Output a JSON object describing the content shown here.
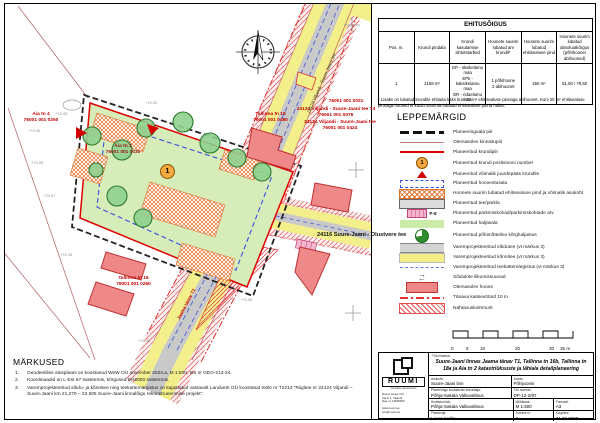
{
  "ehitusoigus": {
    "title": "EHITUSÕIGUS",
    "headers": [
      "Pos. nr.",
      "Krundi pindala",
      "Krundi kasutamise sihtotstarbed",
      "Hoonete suurim lubatud arv krundil*",
      "Hoonete suurim lubatud ehitisealune pind",
      "Hoonete suurim lubatud absoluutkõrgus (põhihoone/ abihooned)"
    ],
    "row": {
      "pos": "1",
      "pindala": "2169 m²",
      "sihtotstarbed": "EP - üksikelamu maa\nEPk - kaksikelamu maa\nER - ridaelamu maa",
      "arv": "1 põhihoone\n2 abihoonet",
      "pind": "450 m²",
      "korgus": "81,50 / 79,50"
    },
    "footnote": "* Lisaks on lubatud krundile ehitada kaks kuni 20 m² ehitisealuse pinnaga abihoonet. Kuni 20 m² ehitisealuse pinnaga hooned ei kuulu suurima lubatud ehitisealuse pinna hulka."
  },
  "leppemargid": {
    "title": "LEPPEMÄRGID",
    "items": [
      {
        "label": "Planeeringuala piir"
      },
      {
        "label": "Olemasolev kinnistupiir"
      },
      {
        "label": "Planeeritud krundipiir"
      },
      {
        "label": "Planeeritud krundi positsiooni number",
        "tag": "1"
      },
      {
        "label": "Planeeritud võimalik juurdepääs krundile"
      },
      {
        "label": "Planeeritud hoonestusala"
      },
      {
        "label": "Hoonete suurim lubatud ehitisealune pind ja võimalik asukoht"
      },
      {
        "label": "Planeeritud tee/parkla"
      },
      {
        "label": "Planeeritud parkimiskohad/parkimiskohtade arv",
        "tag": "P-8"
      },
      {
        "label": "Planeeritud haljasala"
      },
      {
        "label": "Planeeritud põhimõtteline kõrghaljastus"
      },
      {
        "label": "Varemprojekteeritud sõidutee (vt märkus 3)"
      },
      {
        "label": "Varemprojekteeritud kõnnitee (vt märkus 3)"
      },
      {
        "label": "Varemprojekteeritud teekattemärgistus (vt märkus 3)"
      },
      {
        "label": "Sõidukite liikumissuunad"
      },
      {
        "label": "Olemasolev hoone"
      },
      {
        "label": "Tänava kaitsevöönd 10 m"
      },
      {
        "label": "Nähtavuskolmnurk"
      }
    ],
    "arrow_right": "→",
    "arrow_left": "←"
  },
  "markused": {
    "title": "MÄRKUSED",
    "items": [
      {
        "n": "1.",
        "text": "Geodeetilise alusplaani on koostanud WeW OÜ november 2024.a, M 1:500, töö nr GEO-213-24."
      },
      {
        "n": "2.",
        "text": "Koordinaadid on L-Est 97 süsteemis, kõrgused EH2000 süsteemis."
      },
      {
        "n": "3.",
        "text": "Varemprojekteeritud sõidu- ja kõnnitee ning teekattemärgistus on kajastatud vastavalt Landverk OÜ koostatud tööle nr T2213 \"Riigitee nr 24124 Viljandi – Suure-Jaani km 21,270 – 22,505 Suure-Jaani linnalõigu rekonstrueerimise projekt\"."
      }
    ]
  },
  "titleblock": {
    "work_label": "Töö nimetus:",
    "work_title": "Suure-Jaani linnas Jaama tänav T1, Tallinna tn 16b, Tallinna tn 18a ja Aia tn 2 katastriüksuste ja lähiala detailplaneering",
    "asukoht_label": "Asukoht:",
    "asukoht": "Suure-Jaani linn",
    "joonis_label": "Joonis:",
    "joonis": "Põhijoonis",
    "korraldaja_label": "Planeeringu koostamise korraldaja:",
    "korraldaja": "Põhja-Sakala Vallavalitsus",
    "toonumber_label": "Töö number:",
    "toonumber": "DP-12-2/97",
    "huvitatud_label": "Huvitatud isik:",
    "huvitatud": "Põhja-Sakala Vallavalitsus",
    "mootkava_label": "Mõõtkava:",
    "mootkava": "M 1:500",
    "formaat_label": "Formaat:",
    "formaat": "A3",
    "planeerija_label": "Planeerija:",
    "planeerija": "Laura Andla",
    "joonisenr_label": "Joonise nr:",
    "joonisenr": "3",
    "kuupaev_label": "Kuupäev:",
    "kuupaev": "31.03.2025",
    "logo": {
      "name": "RUUMI",
      "sub": "ruumiline planeerimine",
      "lines": [
        "Ruumi Grupp OÜ",
        "Aia tn 1, Viljandi",
        "Reg. nr 14528359",
        "www.ruumi.ee",
        "info@ruumi.ee"
      ]
    }
  },
  "map": {
    "parcels": {
      "aia4": {
        "name": "Aia tn 4",
        "code": "76001 001 0250"
      },
      "tallinna18": {
        "name": "Tallinna tn 18",
        "code": "76001 001 0480"
      },
      "aia2": {
        "name": "Aia tn 2",
        "code": "76001 001 0030"
      },
      "tallinna16": {
        "name": "Tallinna tn 16",
        "code": "76001 001 0260"
      }
    },
    "roads": {
      "code1": "76001 001 0021",
      "t4_name": "24124 Viljandi - Suure-Jaani tee T4",
      "t4_code": "76001 001 0075",
      "main_name": "24124 Viljandi - Suure-Jaani tee",
      "main_code": "76001 001 0424",
      "main_label_rotated": "24124 Viljandi - Suure-Jaani tee",
      "olustvere": "24116 Suure-Jaani - Olustvere tee",
      "jaama": "Jaama tänav T1"
    },
    "pos_number": "1",
    "elevations": [
      "+74.40",
      "+74.05",
      "+74.07",
      "+74.45",
      "+74.22",
      "+73.95",
      "+74.18",
      "+74.36"
    ],
    "scale_ticks": [
      "0",
      "5",
      "10",
      "20",
      "30",
      "35 m"
    ]
  }
}
